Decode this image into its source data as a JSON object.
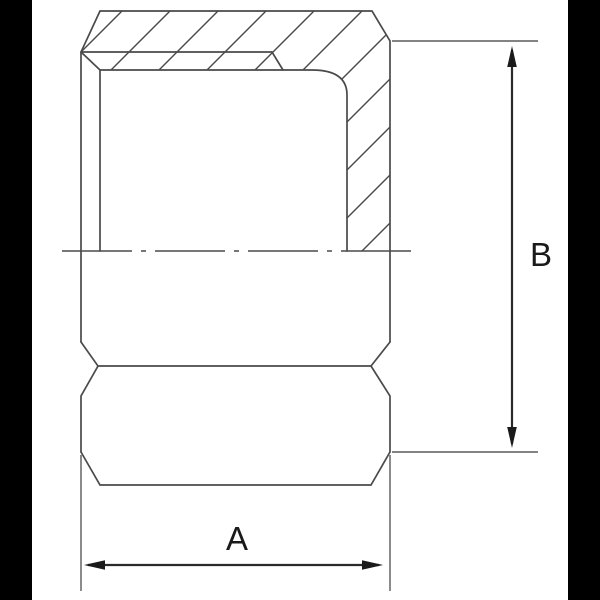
{
  "diagram": {
    "type": "technical-drawing",
    "subject": "hex cap fitting half-section with dimension callouts",
    "dimension_labels": {
      "width": "A",
      "height": "B"
    },
    "colors": {
      "background": "#ffffff",
      "side_bands": "#000000",
      "outline": "#4a4a4a",
      "hatch": "#4a4a4a",
      "dimension_line": "#2a2a2a",
      "arrowhead": "#1a1a1a",
      "label_text": "#1a1a1a"
    }
  }
}
